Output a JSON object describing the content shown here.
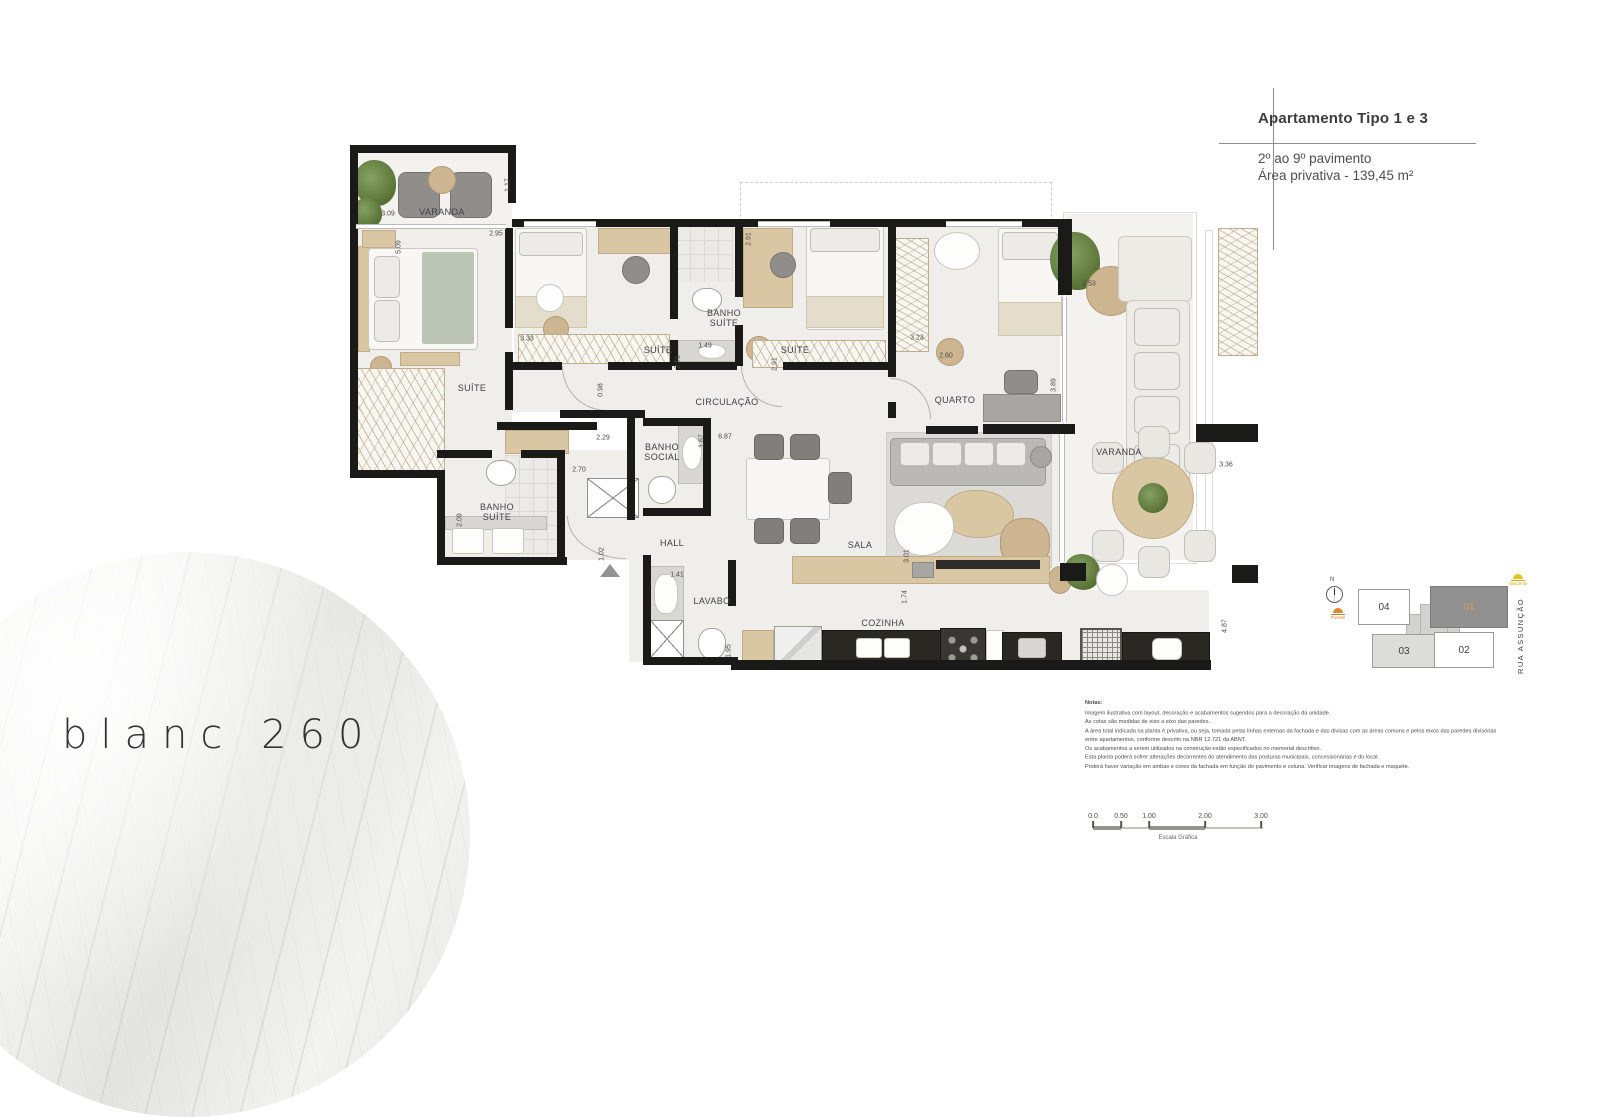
{
  "logo": {
    "text": "blanc 260"
  },
  "title_block": {
    "title": "Apartamento Tipo 1 e 3",
    "subtitle1": "2º ao 9º pavimento",
    "subtitle2": "Área privativa - 139,45 m²"
  },
  "plan": {
    "rooms": [
      {
        "label": "VARANDA",
        "x": 442,
        "y": 212
      },
      {
        "label": "SUÍTE",
        "x": 472,
        "y": 388
      },
      {
        "label": "SUÍTE",
        "x": 658,
        "y": 350
      },
      {
        "label": "BANHO\nSUÍTE",
        "x": 724,
        "y": 318
      },
      {
        "label": "SUÍTE",
        "x": 795,
        "y": 350
      },
      {
        "label": "QUARTO",
        "x": 955,
        "y": 400
      },
      {
        "label": "CIRCULAÇÃO",
        "x": 727,
        "y": 402
      },
      {
        "label": "VARANDA",
        "x": 1119,
        "y": 452
      },
      {
        "label": "BANHO\nSOCIAL",
        "x": 662,
        "y": 452
      },
      {
        "label": "BANHO\nSUÍTE",
        "x": 497,
        "y": 512
      },
      {
        "label": "HALL",
        "x": 672,
        "y": 543
      },
      {
        "label": "LAVABO",
        "x": 712,
        "y": 601
      },
      {
        "label": "SALA",
        "x": 860,
        "y": 545
      },
      {
        "label": "COZINHA",
        "x": 883,
        "y": 623
      }
    ],
    "dimensions": [
      {
        "v": "3.09",
        "x": 388,
        "y": 214
      },
      {
        "v": "1.17",
        "x": 508,
        "y": 185,
        "rot": 1
      },
      {
        "v": "2.95",
        "x": 496,
        "y": 234
      },
      {
        "v": "5.09",
        "x": 399,
        "y": 247,
        "rot": 1
      },
      {
        "v": "3.33",
        "x": 527,
        "y": 339
      },
      {
        "v": "0.98",
        "x": 601,
        "y": 390,
        "rot": 1
      },
      {
        "v": "2.91",
        "x": 749,
        "y": 239,
        "rot": 1
      },
      {
        "v": "1.49",
        "x": 705,
        "y": 346
      },
      {
        "v": "2.91",
        "x": 678,
        "y": 362,
        "rot": 1
      },
      {
        "v": "2.91",
        "x": 775,
        "y": 364,
        "rot": 1
      },
      {
        "v": "3.23",
        "x": 917,
        "y": 338
      },
      {
        "v": "2.60",
        "x": 946,
        "y": 356
      },
      {
        "v": "2.53",
        "x": 1089,
        "y": 284
      },
      {
        "v": "3.89",
        "x": 1054,
        "y": 385,
        "rot": 1
      },
      {
        "v": "2.29",
        "x": 603,
        "y": 438
      },
      {
        "v": "1.67",
        "x": 702,
        "y": 441,
        "rot": 1
      },
      {
        "v": "6.87",
        "x": 725,
        "y": 437
      },
      {
        "v": "2.70",
        "x": 579,
        "y": 470
      },
      {
        "v": "2.09",
        "x": 460,
        "y": 520,
        "rot": 1
      },
      {
        "v": "1.02",
        "x": 602,
        "y": 554,
        "rot": 1
      },
      {
        "v": "1.41",
        "x": 677,
        "y": 575
      },
      {
        "v": "1.95",
        "x": 729,
        "y": 651,
        "rot": 1
      },
      {
        "v": "3.01",
        "x": 907,
        "y": 556,
        "rot": 1
      },
      {
        "v": "1.74",
        "x": 905,
        "y": 597,
        "rot": 1
      },
      {
        "v": "3.36",
        "x": 1226,
        "y": 465
      },
      {
        "v": "4.87",
        "x": 1225,
        "y": 626,
        "rot": 1
      }
    ]
  },
  "key_plan": {
    "north_label": "N",
    "street": "RUA ASSUNÇÃO",
    "sun_west_label": "Poente",
    "sun_east_label": "Nascente",
    "units": [
      {
        "id": "04"
      },
      {
        "id": "01"
      },
      {
        "id": "03"
      },
      {
        "id": "02"
      }
    ]
  },
  "notes": {
    "heading": "Notas:",
    "lines": [
      "Imagem ilustrativa com layout, decoração e acabamentos sugeridos para a decoração da unidade.",
      "As cotas são medidas de eixo a eixo das paredes.",
      "A área total indicada na planta é privativa, ou seja, tomada pelas linhas externas da fachada e das divisas com as áreas comuns e pelos eixos das paredes divisórias",
      "entre apartamentos, conforme descrito na NBR 12.721 da ABNT.",
      "Os acabamentos a serem utilizados na construção estão especificados no memorial descritivo.",
      "Esta planta poderá sofrer alterações decorrentes do atendimento das posturas municipais, concessionárias e do local.",
      "Poderá haver variação em ambas e cores da fachada em função do pavimento e coluna. Verificar imagens de fachada e maquete."
    ]
  },
  "scale_bar": {
    "labels": [
      {
        "t": "0.0",
        "x": 0
      },
      {
        "t": "0.50",
        "x": 28
      },
      {
        "t": "1.00",
        "x": 56
      },
      {
        "t": "2.00",
        "x": 112
      },
      {
        "t": "3.00",
        "x": 168
      }
    ],
    "caption": "Escala Gráfica"
  },
  "colors": {
    "wall": "#1a1a19",
    "highlight_unit": "#909090",
    "unit_label_accent": "#d99c55",
    "sun_west": "#d98a2f",
    "sun_east": "#e0c31f"
  }
}
